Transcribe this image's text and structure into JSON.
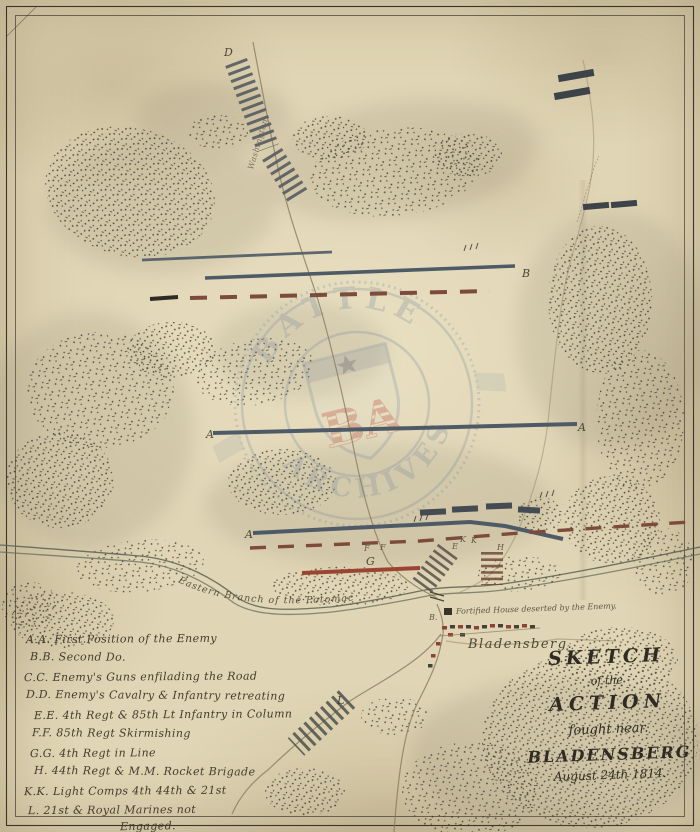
{
  "map": {
    "letters": [
      "D",
      "B",
      "A",
      "A",
      "A",
      "E",
      "F",
      "F",
      "G",
      "K",
      "K",
      "H",
      "L",
      "B."
    ],
    "places": {
      "river": "Eastern Branch of the Potomac",
      "town": "Bladensberg.",
      "house_note": "Fortified House deserted by the Enemy.",
      "road_top": "Washington"
    }
  },
  "watermark": {
    "top": "BATTLE",
    "bottom": "ARCHIVES",
    "monogram": "BA"
  },
  "legend": {
    "items": [
      "A.A. First Position of the Enemy",
      "B.B. Second Do.",
      "C.C. Enemy's Guns enfilading the Road",
      "D.D. Enemy's Cavalry & Infantry retreating",
      "E.E. 4th Regt & 85th Lt Infantry in Column",
      "F.F. 85th Regt Skirmishing",
      "G.G. 4th Regt in Line",
      "H. 44th Regt & M.M. Rocket Brigade",
      "K.K. Light Comps 4th 44th & 21st",
      "L. 21st & Royal Marines not"
    ],
    "continuation": "Engaged."
  },
  "title": {
    "line1": "SKETCH",
    "line2": "of the",
    "line3": "ACTION",
    "line4": "fought near.",
    "line5": "BLADENSBERG",
    "line6": "August 24th 1814."
  },
  "colors": {
    "ink_blue_gray": "#4e5a66",
    "ink_red_brown": "#7d4636",
    "ink_bright_red": "#9c4433",
    "watermark_blue": "#8291a1",
    "watermark_red": "#b5463b",
    "parchment": "#e0d5b4"
  }
}
